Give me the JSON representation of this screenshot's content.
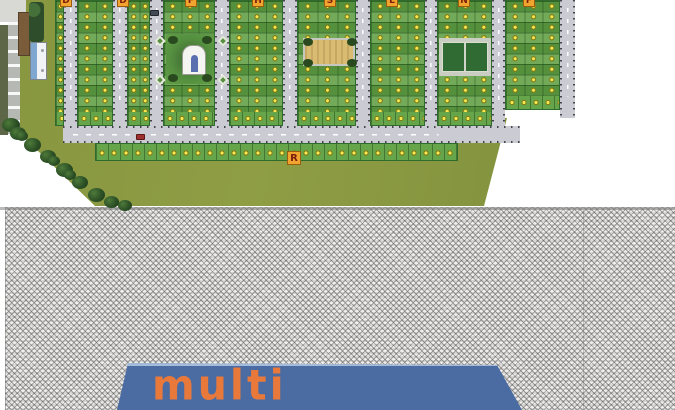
{
  "site_plan": {
    "section_markers": [
      "D",
      "D",
      "F",
      "H",
      "S",
      "L",
      "N",
      "F"
    ],
    "road_marker": "R",
    "colors": {
      "plot_green": "#63a046",
      "lawn_green": "#8b9a43",
      "road_gray": "#cbccd3",
      "marker_yellow": "#efe84e",
      "badge_orange": "#f2a52e",
      "tree_green": "#2c5026",
      "sand_tan": "#d9bc72",
      "court_green": "#2f6b33"
    },
    "icons": [
      "tree-icon",
      "temple-icon",
      "sand-playground-icon",
      "sports-court-icon",
      "site-office-icon",
      "car-icon",
      "plot-marker-icon"
    ]
  },
  "watermark": {
    "pattern": "zigzag-hatch",
    "hatch_color": "#7a7a7a",
    "background": "#f0efed"
  },
  "logo": {
    "text": "multi",
    "background_color": "#4a6ca3",
    "text_color": "#e8793b",
    "highlight_color": "#a4bcd9"
  }
}
